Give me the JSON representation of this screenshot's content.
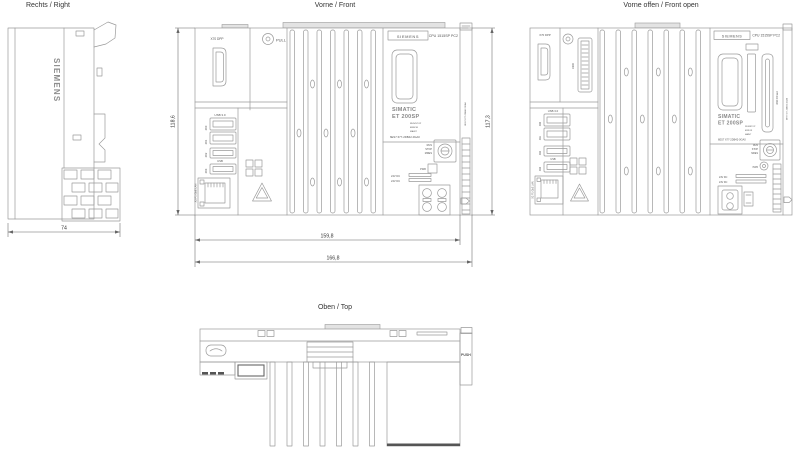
{
  "device": {
    "brand": "SIEMENS",
    "model": "CPU 1515SP PC2",
    "family_line1": "SIMATIC",
    "family_line2": "ET 200SP",
    "article_number": "6ES7 677-2DB42-0GA0"
  },
  "views": {
    "right": {
      "title": "Rechts / Right",
      "dim_depth": "74"
    },
    "front": {
      "title": "Vorne / Front",
      "dim_height_left": "118,6",
      "dim_height_right": "117,3",
      "dim_width_inner": "159,8",
      "dim_width_outer": "166,8"
    },
    "front_open": {
      "title": "Vorne offen / Front open"
    },
    "top": {
      "title": "Oben / Top"
    }
  },
  "labels": {
    "displayport": "X70 DPP",
    "pull": "PULL",
    "push": "PUSH",
    "usb_group": "USB 3.0",
    "usb_single": "USB",
    "usb_x60": "X60",
    "usb_x61": "X61",
    "usb_x62": "X62",
    "usb_x63": "X63",
    "lan": "X2 P1 GbE LAN",
    "x300": "X300",
    "cfast": "X90 CFast",
    "led_run": "RUN/STOP",
    "led_error": "ERROR",
    "led_maint": "MAINT",
    "run": "RUN",
    "stop": "STOP",
    "mres": "MRES",
    "pwr": "PWR",
    "power_24v": "24V DC"
  }
}
